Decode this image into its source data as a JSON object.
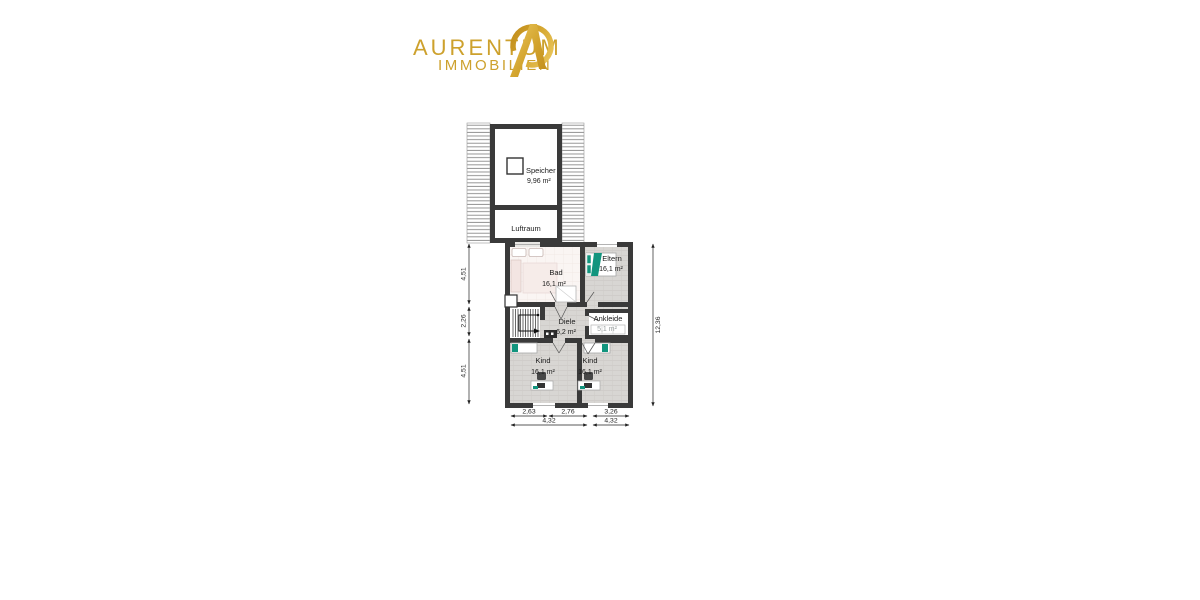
{
  "brand": {
    "name": "AURENTUM",
    "subtitle": "IMMOBILIEN",
    "gold": "#cda12d"
  },
  "floorplan": {
    "rooms": {
      "speicher": {
        "name": "Speicher",
        "area": "9,96 m²"
      },
      "luftraum": {
        "name": "Luftraum"
      },
      "bad": {
        "name": "Bad",
        "area": "16,1 m²"
      },
      "eltern": {
        "name": "Eltern",
        "area": "16,1 m²"
      },
      "diele": {
        "name": "Diele",
        "area": "6,2 m²"
      },
      "ankleide": {
        "name": "Ankleide",
        "area": "5,1 m²"
      },
      "kind_left": {
        "name": "Kind",
        "area": "16,1 m²"
      },
      "kind_right": {
        "name": "Kind",
        "area": "16,1 m²"
      }
    },
    "dimensions": {
      "left_top": "4,51",
      "left_mid": "2,26",
      "left_bottom": "4,51",
      "right_total": "12,36",
      "bottom_left": "2,63",
      "bottom_mid": "2,76",
      "bottom_right": "3,26",
      "bottom_total_left": "4,32",
      "bottom_total_right": "4,32"
    },
    "colors": {
      "wall": "#3a3a3a",
      "floor": "#d8d6d3",
      "accent": "#12957e",
      "bad_floor": "#faf5f3"
    }
  }
}
